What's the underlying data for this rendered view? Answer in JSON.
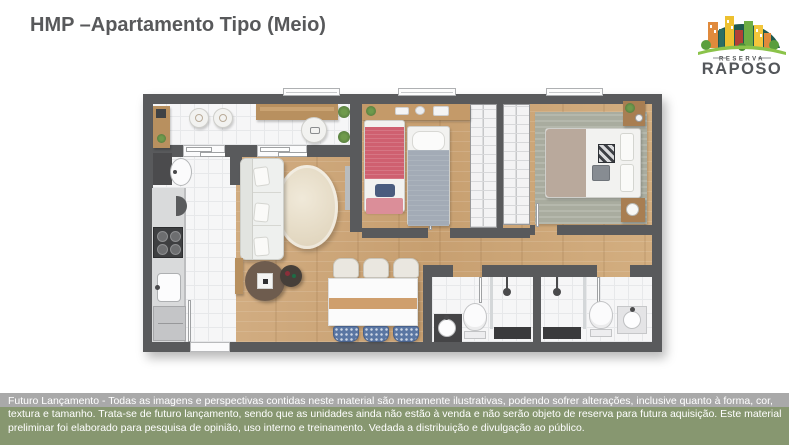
{
  "header": {
    "title": "HMP –Apartamento Tipo (Meio)"
  },
  "logo": {
    "top_text": "RESERVA",
    "main_text": "RAPOSO"
  },
  "disclaimer": {
    "lines": [
      "Futuro Lançamento - Todas as imagens e perspectivas contidas neste material são meramente ilustrativas, podendo sofrer alterações, inclusive quanto à forma, cor,",
      "textura e tamanho. Trata-se de futuro lançamento, sendo que as unidades ainda não estão à venda e não serão objeto de reserva para futura aquisição. Este material",
      "preliminar foi elaborado para pesquisa de opinião, uso interno e treinamento. Vedada a distribuição e divulgação ao público."
    ]
  },
  "palette": {
    "title_gray": "#58595b",
    "wall_gray": "#595a5c",
    "wood_floor": "#cfab7d",
    "tile_floor": "#f6f6f7",
    "band_gray": "#a9a9a9",
    "band_green": "#879770",
    "pink_bed": "#cf6070",
    "gray_bed": "#a3abb6",
    "logo_text": "#53565a"
  }
}
